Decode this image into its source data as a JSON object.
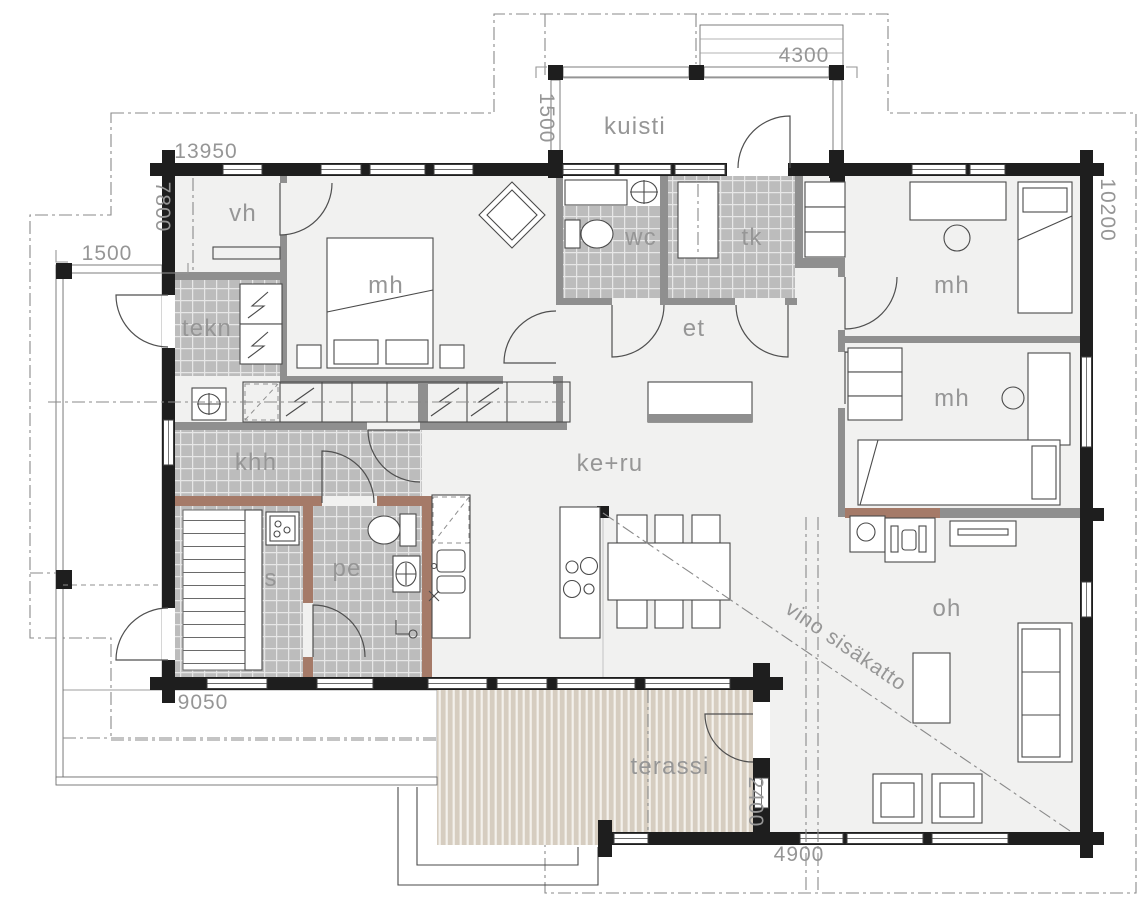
{
  "rooms": {
    "vh": "vh",
    "mh_nw": "mh",
    "wc": "wc",
    "tk": "tk",
    "mh_ne": "mh",
    "tekn": "tekn",
    "et": "et",
    "khh": "khh",
    "mh_e": "mh",
    "keru": "ke+ru",
    "s": "s",
    "pe": "pe",
    "oh": "oh",
    "kuisti": "kuisti",
    "terassi": "terassi"
  },
  "dimensions": {
    "top_width": "13950",
    "left_height": "7800",
    "terrace_width": "1500",
    "porch_depth": "1500",
    "porch_width": "4300",
    "right_height": "10200",
    "deck_width": "9050",
    "terassi_depth": "2400",
    "terassi_width": "4900"
  },
  "annotations": {
    "sloped_ceiling": "vino sisäkatto"
  },
  "colors": {
    "wall": "#1e1e1e",
    "partition": "#8f8f8f",
    "sauna_wall": "#a57a68",
    "tile": "#bcbcbc",
    "grout": "#e6e6e6",
    "floor": "#f1f1f0",
    "deck": "#d6cdc0",
    "deck_stripe": "#f4f1ec",
    "line": "#4a4a4a",
    "dim_text": "#969696",
    "dashdot": "#8a8a8a"
  }
}
